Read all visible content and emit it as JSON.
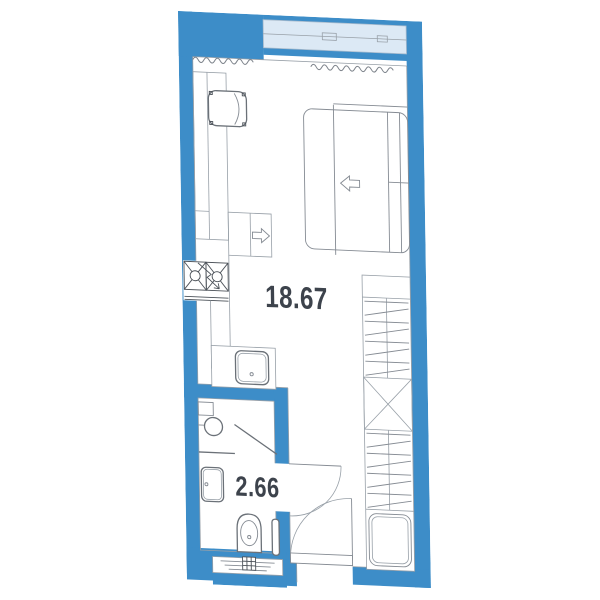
{
  "meta": {
    "type": "studio apartment floor plan"
  },
  "rooms": [
    {
      "id": "main-room",
      "area_label": "18.67"
    },
    {
      "id": "bathroom",
      "area_label": "2.66"
    }
  ],
  "colors": {
    "wall": "#3d8dc8",
    "glass": "#dce9f5",
    "outline": "#98a0a8",
    "furn": "#858b93",
    "dark": "#4b5158",
    "text": "#3d434c",
    "bg": "#ffffff"
  },
  "fixtures": [
    "window",
    "radiator-wave-icon",
    "bed",
    "fold-out-arrow-left-icon",
    "desk",
    "armchair",
    "nightstand",
    "pull-out-arrow-right-icon",
    "cooktop",
    "lightning-icon",
    "kitchen-sink",
    "wardrobe",
    "hanger-hatch-icon",
    "shelf-x-icon",
    "cabinet",
    "shower-head-icon",
    "shower-screen",
    "washbasin",
    "toilet",
    "towel-rail",
    "bathroom-door-swing",
    "entrance-door-swing",
    "ventilation-shaft-icon"
  ]
}
